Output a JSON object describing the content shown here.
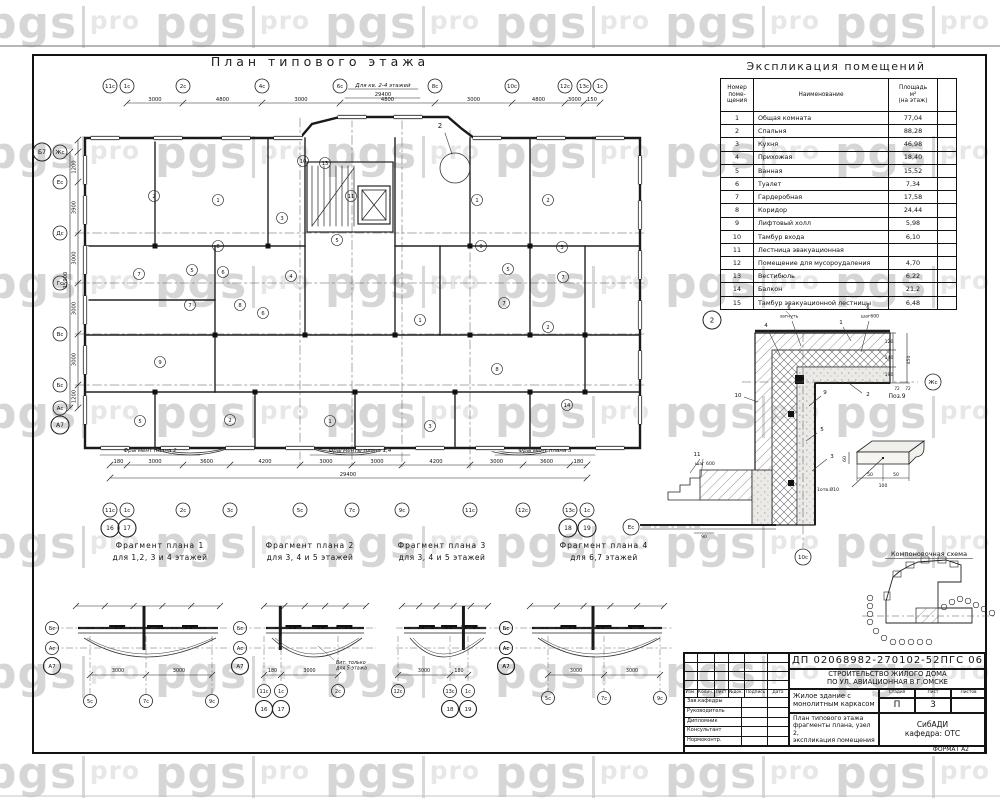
{
  "watermark": {
    "bold": "pgs",
    "light": "pro"
  },
  "sheet": {
    "plan_title": "План типового этажа",
    "expl_title": "Экспликация помещений",
    "scheme_title": "Компоновочная схема"
  },
  "main_plan": {
    "note": "Для кв. 2-4 этажей",
    "total_top": "29400",
    "total_bottom": "29400",
    "total_left": "15900",
    "detail_callout": "2",
    "top_axes": [
      "11с",
      "1с",
      "2с",
      "4с",
      "6с",
      "8с",
      "10с",
      "12с",
      "13с",
      "1с"
    ],
    "top_dims": [
      "3000",
      "4800",
      "3000",
      "4800",
      "3000",
      "4800",
      "3000",
      "150"
    ],
    "bottom_axes": [
      "11с",
      "1с",
      "2с",
      "3с",
      "5с",
      "7с",
      "9с",
      "11с",
      "12с",
      "13с",
      "1с"
    ],
    "bottom_big_axes": [
      "16",
      "17",
      "18",
      "19"
    ],
    "bottom_dims": [
      "180",
      "3000",
      "3600",
      "4200",
      "3000",
      "3000",
      "4200",
      "3000",
      "3600",
      "180"
    ],
    "left_axes": [
      "Жс",
      "Ес",
      "Дс",
      "Гс",
      "Вс",
      "Бс",
      "Ас"
    ],
    "left_big_axes": [
      "Б7",
      "А7"
    ],
    "left_dims": [
      "1200",
      "3900",
      "3000",
      "3000",
      "3000",
      "1200"
    ],
    "fragment_refs": [
      "Фрагмент плана 2",
      "Фрагменты плана 1,4",
      "Фрагмент плана 3"
    ],
    "room_numbers": [
      "2",
      "1",
      "3",
      "1",
      "2",
      "10",
      "13",
      "11",
      "7",
      "5",
      "6",
      "4",
      "8",
      "5",
      "9",
      "5",
      "3",
      "7",
      "7",
      "8",
      "6",
      "7",
      "2",
      "8",
      "14",
      "9",
      "2",
      "1",
      "3",
      "5",
      "1"
    ]
  },
  "explication": {
    "col1": "Номер\nпоме-\nщения",
    "col2": "Наименование",
    "col3": "Площадь\nм²\n(на этаж)",
    "rows": [
      [
        "1",
        "Общая комната",
        "77,04"
      ],
      [
        "2",
        "Спальня",
        "88,28"
      ],
      [
        "3",
        "Кухня",
        "46,98"
      ],
      [
        "4",
        "Прихожая",
        "18,40"
      ],
      [
        "5",
        "Ванная",
        "15,52"
      ],
      [
        "6",
        "Туалет",
        "7,34"
      ],
      [
        "7",
        "Гардеробная",
        "17,58"
      ],
      [
        "8",
        "Коридор",
        "24,44"
      ],
      [
        "9",
        "Лифтовый холл",
        "5,98"
      ],
      [
        "10",
        "Тамбур входа",
        "6,10"
      ],
      [
        "11",
        "Лестница эвакуационная",
        ""
      ],
      [
        "12",
        "Помещение для мусороудаления",
        "4,70"
      ],
      [
        "13",
        "Вестибюль",
        "6,22"
      ],
      [
        "14",
        "Балкон",
        "21,2"
      ],
      [
        "15",
        "Тамбур эвакуационной лестницы",
        "6,48"
      ]
    ]
  },
  "node2": {
    "labels": {
      "callout": "2",
      "n1": "1",
      "n2": "2",
      "n3": "3",
      "n4": "4",
      "n5": "5",
      "n6a": "6",
      "n6b": "6",
      "n9": "9",
      "n10": "10",
      "n11": "11",
      "note_bend": "загнуть",
      "note_step": "шаг600",
      "note_step2": "шаг 600",
      "d120": "120",
      "d140": "140",
      "d190": "190",
      "d450": "450",
      "d72a": "72",
      "d72b": "72",
      "d90": "90",
      "axis_right": "Жс",
      "axis_left": "Ес",
      "axis_bottom": "10с",
      "pos9_title": "Поз.9",
      "pos9_note": "1отв.Ø10",
      "p50a": "50",
      "p50b": "50",
      "p100": "100",
      "p60": "60"
    }
  },
  "fragments": [
    {
      "title": "Фрагмент плана 1",
      "subtitle": "для 1,2, 3 и 4 этажей",
      "side_axes": [
        "Бс",
        "Ас"
      ],
      "corner_axis": "А7",
      "bottom_axes": [
        "5с",
        "7с",
        "9с"
      ],
      "big_axes": [],
      "dims": [
        "3000",
        "3000"
      ],
      "note": ""
    },
    {
      "title": "Фрагмент плана 2",
      "subtitle": "для 3, 4 и 5 этажей",
      "side_axes": [
        "Бс",
        "Ас"
      ],
      "corner_axis": "А7",
      "bottom_axes": [
        "11с",
        "1с",
        "2с"
      ],
      "big_axes": [
        "16",
        "17"
      ],
      "dims": [
        "180",
        "3000"
      ],
      "note": "Вит. только\nдля 5 этажа"
    },
    {
      "title": "Фрагмент плана 3",
      "subtitle": "для 3, 4 и 5 этажей",
      "side_axes": [
        "Бс",
        "Ас"
      ],
      "corner_axis": "А7",
      "bottom_axes": [
        "12с",
        "13с",
        "1с"
      ],
      "big_axes": [
        "18",
        "19"
      ],
      "dims": [
        "3000",
        "180"
      ],
      "note": ""
    },
    {
      "title": "Фрагмент плана 4",
      "subtitle": "для 6,7 этажей",
      "side_axes": [
        "Бс",
        "Ас"
      ],
      "corner_axis": "А7",
      "bottom_axes": [
        "5с",
        "7с",
        "9с"
      ],
      "big_axes": [],
      "dims": [
        "3000",
        "3000"
      ],
      "note": ""
    }
  ],
  "title_block": {
    "doc_number": "ДП 02068982-270102-52ПГС 06",
    "project": "СТРОИТЕЛЬСТВО ЖИЛОГО ДОМА\nПО УЛ. АВИАЦИОННАЯ В Г.ОМСКЕ",
    "object": "Жилое здание с\nмонолитным каркасом",
    "sheet_title": "План типового этажа\nфрагменты плана, узел 2,\nэкспликация помещения",
    "org": "СибАДИ\nкафедра: ОТС",
    "stage_label": "Стадия",
    "sheet_label": "Лист",
    "sheets_label": "Листов",
    "stage": "П",
    "sheet_no": "3",
    "sheets_total": "",
    "col_headers": [
      "Изм.",
      "Колич.",
      "Лист",
      "№док.",
      "Подпись",
      "Дата"
    ],
    "row_labels": [
      "Зав.кафедры",
      "Руководитель",
      "Дипломник",
      "Консультант",
      "Нормоконтр."
    ],
    "format": "ФОРМАТ А2"
  }
}
